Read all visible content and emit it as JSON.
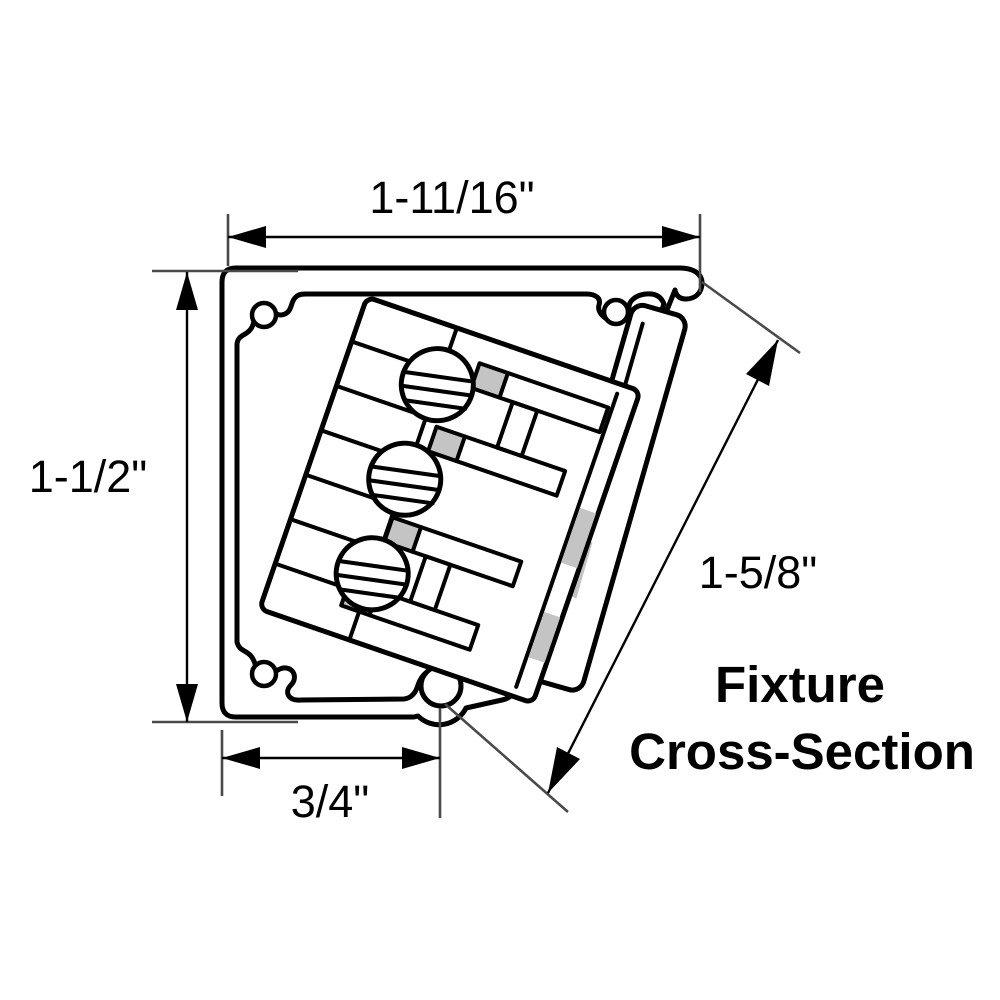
{
  "diagram": {
    "kind": "fixture-cross-section-technical-drawing",
    "title_line1": "Fixture",
    "title_line2": "Cross-Section",
    "dim_top": "1-11/16\"",
    "dim_left": "1-1/2\"",
    "dim_bottom": "3/4\"",
    "dim_diagonal": "1-5/8\"",
    "colors": {
      "line": "#000000",
      "background": "#ffffff",
      "extension_line": "#4a4a4a",
      "hatch_fill": "#c4c4c4"
    }
  }
}
